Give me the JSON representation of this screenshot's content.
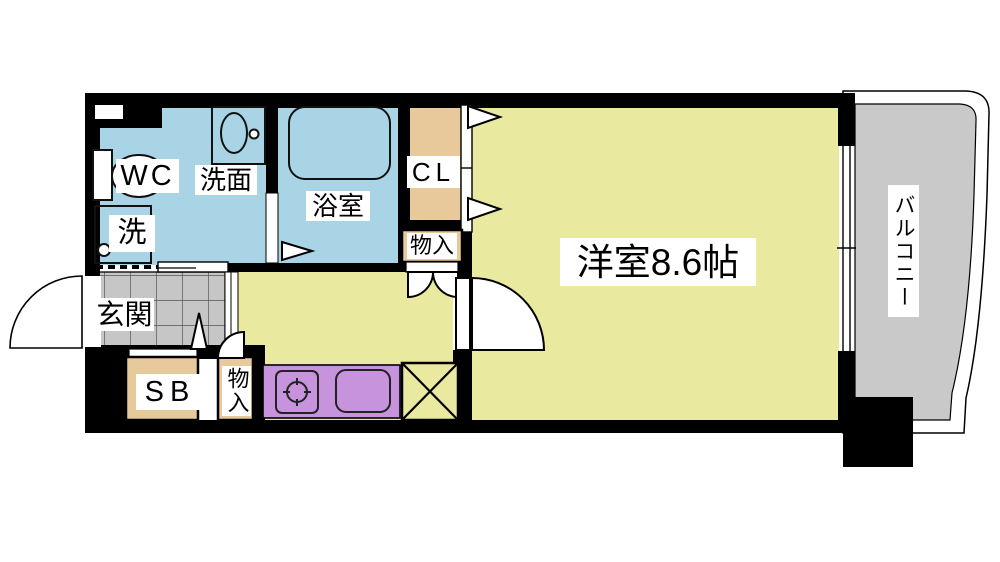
{
  "plan": {
    "title": "apartment-floor-plan",
    "labels": {
      "wc": "WC",
      "washstand": "洗面",
      "laundry": "洗",
      "bathroom": "浴室",
      "closet": "CL",
      "storage_upper": "物入",
      "main_room": "洋室8.6帖",
      "entrance": "玄関",
      "shoe_box": "SB",
      "storage_lower": "物入",
      "balcony": "バルコニー"
    },
    "colors": {
      "wet_area_blue": "#a9d4e6",
      "room_yellow": "#e9ea9f",
      "closet_tan": "#e8c99c",
      "kitchen_purple": "#c793dc",
      "balcony_gray": "#c9c9c9",
      "entrance_tile_gray": "#c6c6c6",
      "wall_black": "#000000"
    }
  }
}
